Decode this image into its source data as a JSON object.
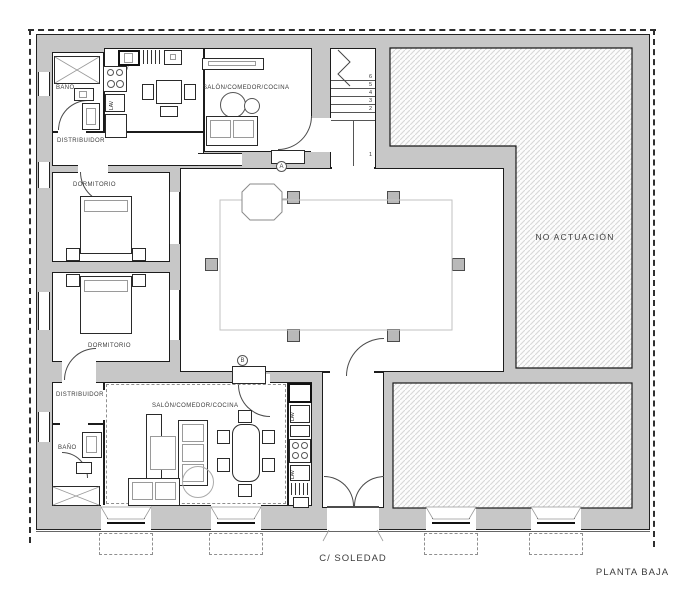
{
  "plan": {
    "title": "PLANTA BAJA",
    "street": "C/ SOLEDAD"
  },
  "rooms": {
    "upper_bath": "BAÑO",
    "upper_hall": "DISTRIBUIDOR",
    "upper_living": "SALÓN/COMEDOR/COCINA",
    "upper_bedroom": "DORMITORIO",
    "lower_bedroom": "DORMITORIO",
    "lower_hall": "DISTRIBUIDOR",
    "lower_bath": "BAÑO",
    "lower_living": "SALÓN/COMEDOR/COCINA",
    "no_action_zone": "NO ACTUACIÓN"
  },
  "labels": {
    "appliance": "LAV"
  },
  "markers": {
    "a": "A",
    "b": "B"
  },
  "stairs": {
    "numbers": [
      "6",
      "5",
      "4",
      "3",
      "2",
      "1"
    ]
  },
  "colors": {
    "wall": "#c7c7c7",
    "line": "#1c1c1c",
    "hatch_line": "#d7d7d7"
  }
}
